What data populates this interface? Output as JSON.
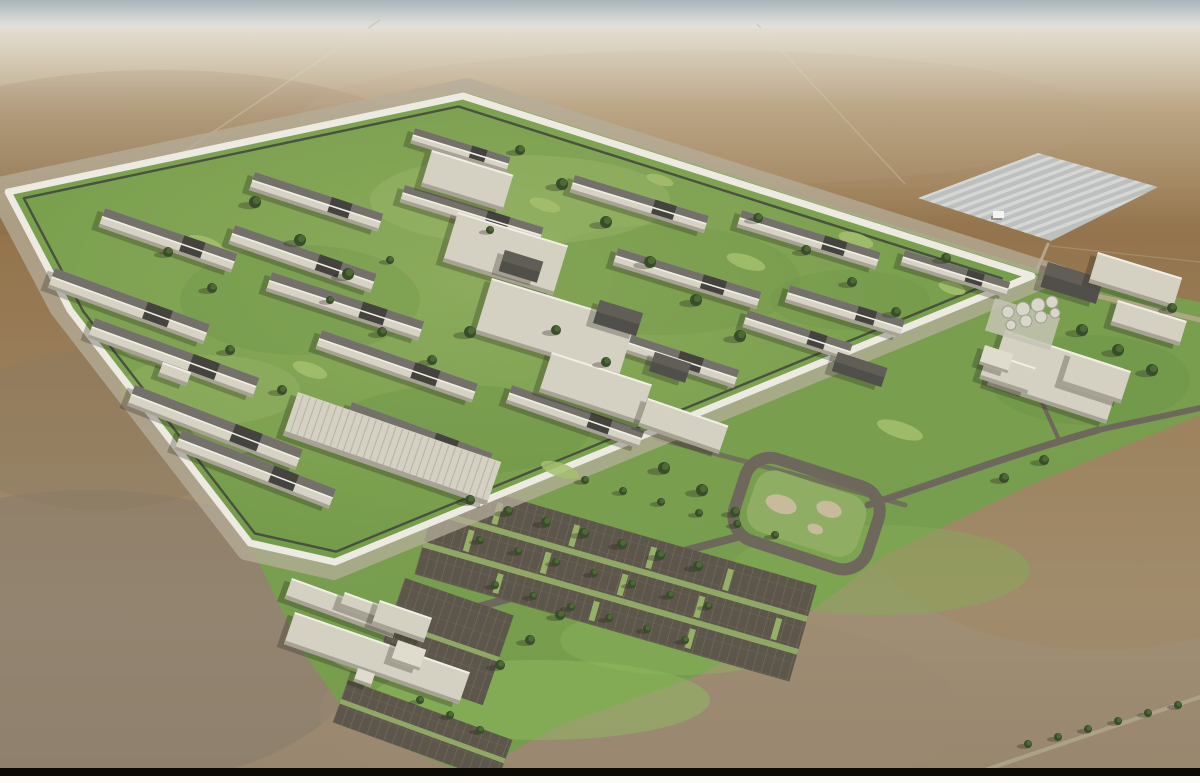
{
  "scene": {
    "title": "Aerial 3D architectural rendering of a large walled correctional facility campus on a flat desert plain",
    "style": "photoreal massing render, high oblique aerial view",
    "time_of_day": "midday, hazy horizon",
    "setting": "arid desert with landscaped green campus"
  },
  "regions": {
    "sky": {
      "label": "hazy sky band at horizon"
    },
    "desert": {
      "label": "flat brown desert plain"
    },
    "solar_farm": {
      "label": "solar panel farm north-east of the facility"
    },
    "site": {
      "label": "landscaped green facility site"
    },
    "compound": {
      "label": "secure walled compound with housing blocks"
    },
    "perimeter_wall": {
      "label": "white perimeter wall with inner patrol road and fence"
    },
    "housing": {
      "label": "long housing unit buildings"
    },
    "spine": {
      "label": "central program and services buildings"
    },
    "industries": {
      "label": "large ribbed-roof industries warehouse"
    },
    "support": {
      "label": "support and utility buildings outside the wall"
    },
    "water_treatment": {
      "label": "circular water treatment tanks"
    },
    "admin": {
      "label": "administration campus buildings"
    },
    "entrance": {
      "label": "public entrance and gatehouse buildings"
    },
    "parking": {
      "label": "visitor and staff parking lots with tree rows"
    },
    "roundabout": {
      "label": "landscaped loop road"
    },
    "roads": {
      "label": "access roads"
    },
    "trees": {
      "label": "tree plantings"
    },
    "frame": {
      "label": "black rule at bottom of page image"
    }
  },
  "colors": {
    "sky-top": "#a9b3ba",
    "sky-horizon": "#efeee9",
    "desert-haze": "#c2b193",
    "desert-mid": "#97794f",
    "desert-low": "#98876e",
    "site-green": "#7aa04e",
    "lawn": "#a4bf6f",
    "grass-dark": "#679043",
    "fringe-green": "#8fb95f",
    "wall-white": "#eceae1",
    "wall-apron": "#b5ad9a",
    "fence-dark": "#3f443c",
    "bldg-light": "#d5d1c2",
    "wall-shade": "#a6a294",
    "roof-light": "#d6d2c4",
    "roof-dark": "#74716a",
    "roof-charcoal": "#45433d",
    "bldg-dark": "#514f49",
    "tree-dark": "#384d2a",
    "tree-light": "#516d37",
    "asphalt": "#5d564a",
    "stall-line": "#8d8576",
    "road": "#6e675c",
    "road-light": "#b2a78e",
    "solar-field": "#bdc0bf",
    "solar-stripe": "#d8dad8",
    "shadow": "#24201a",
    "frame-bar": "#0b0a07",
    "frame-white": "#fcfbf6"
  },
  "layout_data": {
    "buildings": [
      [
        105,
        208,
        140,
        20,
        19,
        "h"
      ],
      [
        255,
        172,
        135,
        19,
        18,
        "h"
      ],
      [
        415,
        128,
        100,
        16,
        17,
        "h"
      ],
      [
        55,
        268,
        165,
        21,
        20,
        "h"
      ],
      [
        235,
        225,
        150,
        20,
        19,
        "h"
      ],
      [
        405,
        185,
        145,
        18,
        17,
        "h"
      ],
      [
        575,
        175,
        140,
        18,
        17,
        "h"
      ],
      [
        742,
        210,
        145,
        18,
        17,
        "h"
      ],
      [
        905,
        250,
        110,
        16,
        17,
        "h"
      ],
      [
        95,
        318,
        175,
        21,
        20,
        "h"
      ],
      [
        272,
        272,
        160,
        20,
        18,
        "h"
      ],
      [
        618,
        248,
        150,
        18,
        17,
        "h"
      ],
      [
        790,
        285,
        120,
        18,
        17,
        "h"
      ],
      [
        135,
        385,
        180,
        22,
        21,
        "h"
      ],
      [
        322,
        330,
        165,
        20,
        19,
        "h"
      ],
      [
        592,
        322,
        155,
        19,
        18,
        "h"
      ],
      [
        748,
        310,
        110,
        18,
        18,
        "h"
      ],
      [
        182,
        430,
        165,
        21,
        21,
        "h"
      ],
      [
        352,
        402,
        150,
        20,
        20,
        "h"
      ],
      [
        512,
        385,
        140,
        19,
        19,
        "h"
      ],
      [
        432,
        150,
        85,
        38,
        17,
        "l"
      ],
      [
        458,
        212,
        115,
        52,
        17,
        "l"
      ],
      [
        492,
        278,
        150,
        58,
        17,
        "l"
      ],
      [
        552,
        352,
        105,
        42,
        18,
        "l"
      ],
      [
        163,
        362,
        30,
        15,
        20,
        "l"
      ],
      [
        505,
        250,
        40,
        22,
        17,
        "d"
      ],
      [
        600,
        300,
        45,
        24,
        17,
        "d"
      ],
      [
        655,
        352,
        38,
        20,
        18,
        "d"
      ],
      [
        838,
        352,
        52,
        20,
        18,
        "d"
      ],
      [
        648,
        398,
        85,
        30,
        19,
        "l"
      ],
      [
        298,
        392,
        215,
        46,
        19,
        "w"
      ],
      [
        1048,
        262,
        58,
        26,
        17,
        "d"
      ],
      [
        1098,
        252,
        88,
        32,
        17,
        "l"
      ],
      [
        1118,
        300,
        72,
        26,
        17,
        "l"
      ],
      [
        1005,
        330,
        125,
        58,
        18,
        "l"
      ],
      [
        988,
        352,
        50,
        28,
        18,
        "l"
      ],
      [
        1072,
        352,
        62,
        34,
        18,
        "l"
      ],
      [
        985,
        345,
        30,
        20,
        18,
        "c"
      ],
      [
        292,
        578,
        115,
        22,
        20,
        "l"
      ],
      [
        345,
        592,
        60,
        16,
        20,
        "l"
      ],
      [
        295,
        612,
        185,
        34,
        19,
        "l"
      ],
      [
        380,
        600,
        55,
        26,
        19,
        "l"
      ],
      [
        358,
        668,
        18,
        14,
        19,
        "c"
      ],
      [
        398,
        640,
        30,
        22,
        19,
        "c"
      ]
    ],
    "trees": [
      [
        255,
        202,
        6
      ],
      [
        300,
        240,
        6
      ],
      [
        348,
        274,
        6
      ],
      [
        168,
        252,
        5
      ],
      [
        212,
        288,
        5
      ],
      [
        520,
        150,
        5
      ],
      [
        562,
        184,
        6
      ],
      [
        606,
        222,
        6
      ],
      [
        650,
        262,
        6
      ],
      [
        696,
        300,
        6
      ],
      [
        740,
        336,
        6
      ],
      [
        470,
        332,
        6
      ],
      [
        432,
        360,
        5
      ],
      [
        382,
        332,
        5
      ],
      [
        556,
        330,
        5
      ],
      [
        606,
        362,
        5
      ],
      [
        758,
        218,
        5
      ],
      [
        806,
        250,
        5
      ],
      [
        852,
        282,
        5
      ],
      [
        896,
        312,
        5
      ],
      [
        946,
        258,
        5
      ],
      [
        230,
        350,
        5
      ],
      [
        282,
        390,
        5
      ],
      [
        330,
        300,
        4
      ],
      [
        490,
        230,
        4
      ],
      [
        390,
        260,
        4
      ],
      [
        470,
        500,
        5
      ],
      [
        508,
        511,
        5
      ],
      [
        546,
        522,
        5
      ],
      [
        584,
        533,
        5
      ],
      [
        622,
        544,
        5
      ],
      [
        660,
        555,
        5
      ],
      [
        698,
        566,
        5
      ],
      [
        480,
        540,
        4
      ],
      [
        518,
        551,
        4
      ],
      [
        556,
        562,
        4
      ],
      [
        594,
        573,
        4
      ],
      [
        632,
        584,
        4
      ],
      [
        670,
        595,
        4
      ],
      [
        708,
        606,
        4
      ],
      [
        495,
        585,
        4
      ],
      [
        533,
        596,
        4
      ],
      [
        571,
        607,
        4
      ],
      [
        609,
        618,
        4
      ],
      [
        647,
        629,
        4
      ],
      [
        685,
        640,
        4
      ],
      [
        585,
        480,
        4
      ],
      [
        623,
        491,
        4
      ],
      [
        661,
        502,
        4
      ],
      [
        699,
        513,
        4
      ],
      [
        737,
        524,
        4
      ],
      [
        775,
        535,
        4
      ],
      [
        420,
        700,
        4
      ],
      [
        450,
        715,
        4
      ],
      [
        480,
        730,
        4
      ],
      [
        530,
        640,
        5
      ],
      [
        560,
        615,
        5
      ],
      [
        500,
        665,
        5
      ],
      [
        1082,
        330,
        6
      ],
      [
        1118,
        350,
        6
      ],
      [
        1152,
        370,
        6
      ],
      [
        1172,
        308,
        5
      ],
      [
        1044,
        460,
        5
      ],
      [
        1004,
        478,
        5
      ],
      [
        664,
        468,
        6
      ],
      [
        702,
        490,
        6
      ],
      [
        735,
        512,
        5
      ],
      [
        1028,
        744,
        4
      ],
      [
        1058,
        737,
        4
      ],
      [
        1088,
        729,
        4
      ],
      [
        1118,
        721,
        4
      ],
      [
        1148,
        713,
        4
      ],
      [
        1178,
        705,
        4
      ]
    ],
    "lawns": [
      [
        222,
        436,
        34,
        13,
        20
      ],
      [
        138,
        348,
        26,
        10,
        20
      ],
      [
        205,
        245,
        20,
        8,
        19
      ],
      [
        448,
        170,
        22,
        8,
        17
      ],
      [
        746,
        262,
        20,
        7,
        17
      ],
      [
        856,
        240,
        18,
        7,
        17
      ],
      [
        545,
        205,
        16,
        6,
        17
      ],
      [
        952,
        288,
        14,
        6,
        17
      ],
      [
        310,
        370,
        18,
        7,
        19
      ],
      [
        660,
        180,
        14,
        5,
        17
      ],
      [
        900,
        430,
        24,
        8,
        18
      ],
      [
        560,
        470,
        20,
        7,
        19
      ],
      [
        352,
        660,
        30,
        10,
        22
      ]
    ],
    "tanks": [
      [
        1008,
        312,
        6
      ],
      [
        1023,
        309,
        7
      ],
      [
        1038,
        305,
        7
      ],
      [
        1052,
        302,
        6
      ],
      [
        1011,
        325,
        5
      ],
      [
        1026,
        321,
        6
      ],
      [
        1041,
        317,
        6
      ],
      [
        1055,
        313,
        5
      ]
    ]
  }
}
